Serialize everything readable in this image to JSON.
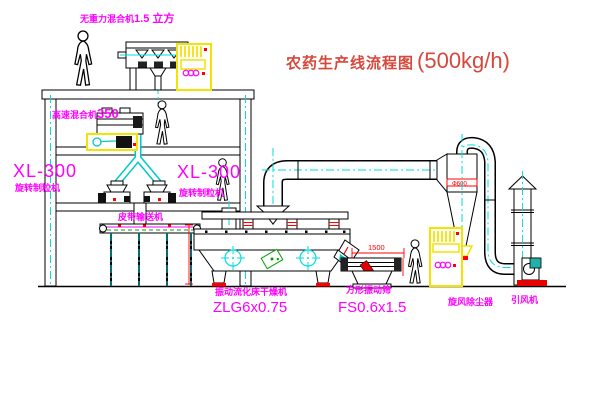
{
  "title": {
    "text": "农药生产线流程图",
    "capacity": "(500kg/h)"
  },
  "labels": {
    "zero_gravity_mixer_name": "无重力混合机",
    "zero_gravity_mixer_capacity": "1.5 立方",
    "high_speed_mixer_name": "高速混合机",
    "high_speed_mixer_capacity": "350",
    "granulator_left_model": "XL-300",
    "granulator_left_name": "旋转制粒机",
    "granulator_mid_model": "XL-300",
    "granulator_mid_name": "旋转制粒机",
    "belt_conveyor": "皮带输送机",
    "dryer_name": "振动流化床干燥机",
    "dryer_model": "ZLG6x0.75",
    "sieve_name": "方形振动筛",
    "sieve_model": "FS0.6x1.5",
    "sieve_dim": "1500",
    "cyclone_name": "旋风除尘器",
    "cyclone_diameter": "Φ600",
    "fan_name": "引风机"
  },
  "colors": {
    "label_magenta": "#ff00ff",
    "title_red": "#d6483c",
    "accent_red": "#ff0000",
    "centerline_cyan": "#00dede",
    "cabinet_yellow": "#f2e300",
    "detail_green": "#00a000"
  }
}
